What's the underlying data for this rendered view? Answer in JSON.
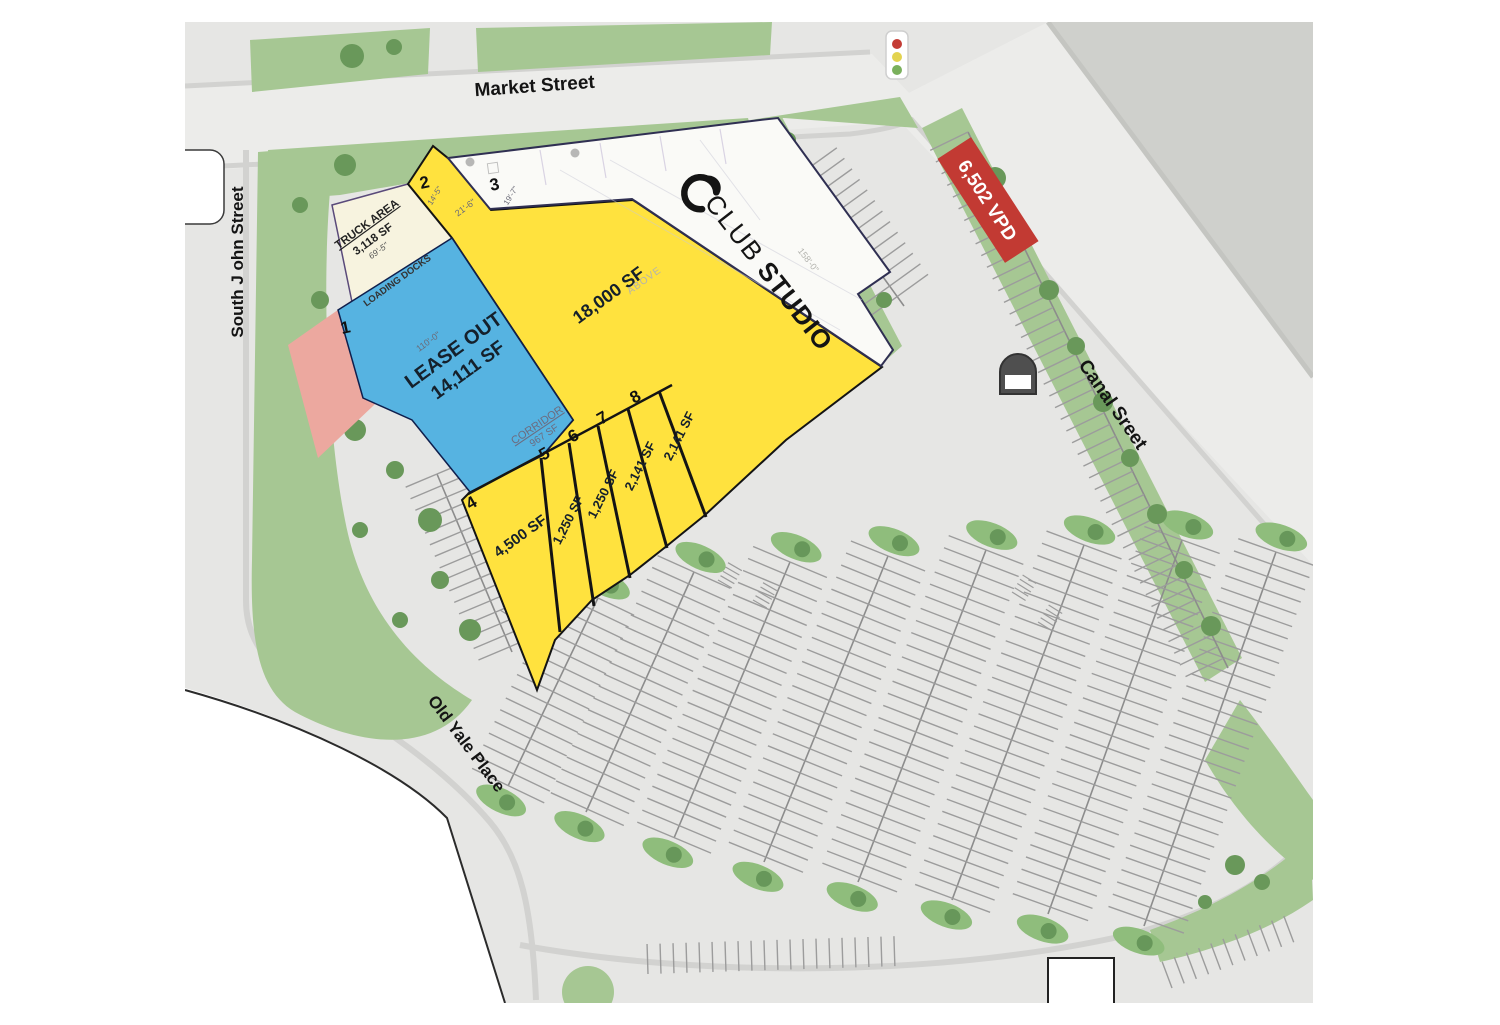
{
  "streets": {
    "market": "Market Street",
    "south_john": "South J ohn Street",
    "canal": "Canal Sreet",
    "old_yale": "Old Yale Place"
  },
  "traffic": {
    "vpd_badge": "6,502 VPD"
  },
  "anchor": {
    "brand_club": "CLUB",
    "brand_studio": "STUDIO"
  },
  "suites": {
    "s1": "1",
    "s2": "2",
    "s3": "3",
    "s4": "4",
    "s5": "5",
    "s6": "6",
    "s7": "7",
    "s8": "8"
  },
  "areas": {
    "lease_out_line1": "LEASE OUT",
    "lease_out_line2": "14,111 SF",
    "main_yellow": "18,000 SF",
    "suite4_sf": "4,500 SF",
    "suite5_sf": "1,250 SF",
    "suite6_sf": "1,250 SF",
    "suite7_sf": "2,141 SF",
    "suite8_sf": "2,141 SF",
    "corridor": "CORRIDOR",
    "corridor_sf": "967 SF"
  },
  "truck": {
    "label": "TRUCK AREA",
    "sf": "3,118 SF",
    "dim": "69'-5\"",
    "docks": "LOADING DOCKS"
  },
  "dimensions": {
    "d110": "110'-0\"",
    "d21": "21'-6\"",
    "d19": "19'-7\"",
    "d14": "14'-5\"",
    "d158": "158'-0\"",
    "above": "ABOVE"
  },
  "colors": {
    "plan_gray": "#e6e6e4",
    "street_gray": "#ececea",
    "curb_gray": "#d2d2d0",
    "block_gray": "#cfd0cc",
    "landscape_green": "#a6c793",
    "island_green": "#8fbd7c",
    "tree_green": "#69985a",
    "suite_yellow": "#ffe23e",
    "lease_blue": "#56b3e1",
    "truck_cream": "#f7f3df",
    "pink": "#eca89f",
    "white_building": "#fafaf7",
    "accent_red": "#c23a33",
    "signal_red": "#c43c35",
    "signal_yellow": "#e3d34f",
    "signal_green": "#7ab05c"
  }
}
